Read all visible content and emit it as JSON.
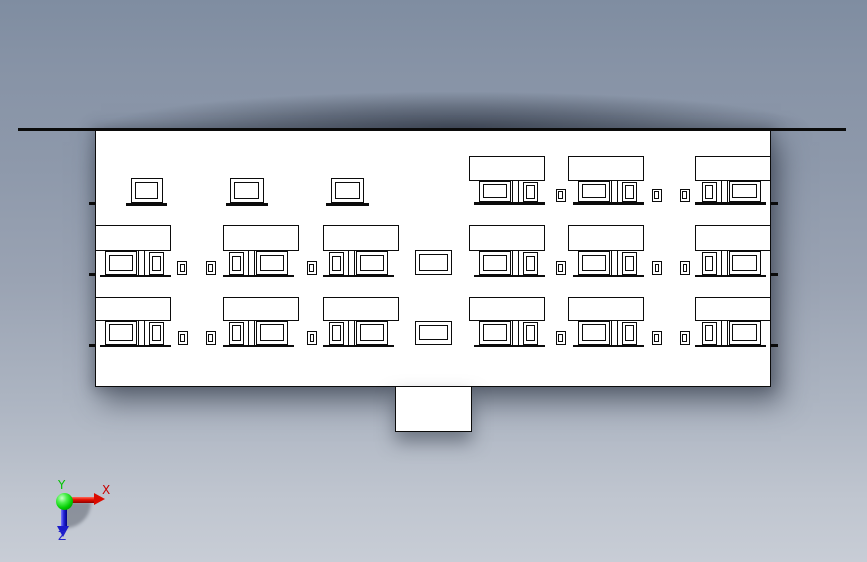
{
  "scene": {
    "colors": {
      "line": "#0b0b0b",
      "fill": "#ffffff",
      "background_top": "#7f8da1",
      "background_bottom": "#c8cdd6"
    }
  },
  "axis_triad": {
    "labels": {
      "x": "X",
      "y": "Y",
      "z": "Z"
    },
    "label_colors": {
      "x": "#c90000",
      "y": "#00c400",
      "z": "#2222cc"
    },
    "origin": {
      "x": 64,
      "y": 501
    }
  },
  "drawing": {
    "canvas": {
      "width": 867,
      "height": 562
    },
    "ground_line": {
      "x": 18,
      "y": 128.3,
      "w": 828,
      "h": 2.8
    },
    "building": {
      "x": 95,
      "y": 130,
      "w": 676,
      "h": 257
    },
    "porch": {
      "x": 395,
      "y": 386.4,
      "w": 76.5,
      "h": 46
    },
    "floor_ticks": {
      "ys": [
        202.2,
        273.4,
        344.0
      ],
      "h": 3,
      "left_x": 88.5,
      "left_w": 6.5,
      "right_x": 771,
      "right_w": 6.5
    },
    "unit_width": 76,
    "units": [
      {
        "id": "unit-1",
        "x": 94.5,
        "panes": "wide-left"
      },
      {
        "id": "unit-2",
        "x": 222.5,
        "panes": "narrow-left"
      },
      {
        "id": "unit-3",
        "x": 322.5,
        "panes": "narrow-left"
      },
      {
        "id": "unit-4",
        "x": 468.5,
        "panes": "wide-left"
      },
      {
        "id": "unit-5",
        "x": 567.5,
        "panes": "wide-left"
      },
      {
        "id": "unit-6",
        "x": 695.0,
        "panes": "narrow-left"
      }
    ],
    "shop_unit_layout": {
      "wide_pane": {
        "x": 10.5,
        "w": 32
      },
      "mullion": {
        "x": 43.5,
        "w": 7
      },
      "narrow_pane": {
        "x": 54.5,
        "w": 15
      },
      "sill": {
        "x": 5,
        "w": 71
      }
    },
    "small_window": {
      "w": 10,
      "h": 13.5
    },
    "rows": [
      {
        "name": "floor-3",
        "awning_y": 156,
        "awning_h": 24.5,
        "window_h": 21.5,
        "sill_h": 2.6,
        "unit_ids": [
          "unit-4",
          "unit-5",
          "unit-6"
        ],
        "plain_window_y": 178,
        "plain_window_h": 25.3,
        "plain_windows": [
          {
            "x": 130.5,
            "w": 32
          },
          {
            "x": 230.0,
            "w": 33.5
          },
          {
            "x": 330.5,
            "w": 33.5
          }
        ],
        "small_windows_x": [
          555.5,
          651.5,
          679.5
        ]
      },
      {
        "name": "floor-2",
        "awning_y": 225.3,
        "awning_h": 26,
        "window_h": 23.4,
        "sill_h": 2.6,
        "unit_ids": [
          "unit-1",
          "unit-2",
          "unit-3",
          "unit-4",
          "unit-5",
          "unit-6"
        ],
        "small_windows_x": [
          177.3,
          205.5,
          306.5,
          555.5,
          651.8,
          680.0
        ],
        "center_window": {
          "x": 415,
          "w": 37.3,
          "h": 25
        }
      },
      {
        "name": "floor-1",
        "awning_y": 297,
        "awning_h": 23.5,
        "window_h": 24,
        "sill_h": 2.6,
        "unit_ids": [
          "unit-1",
          "unit-2",
          "unit-3",
          "unit-4",
          "unit-5",
          "unit-6"
        ],
        "small_windows_x": [
          177.5,
          205.5,
          306.8,
          555.5,
          651.5,
          679.5
        ],
        "center_window": {
          "x": 415,
          "w": 37.3,
          "h": 24
        }
      }
    ]
  }
}
